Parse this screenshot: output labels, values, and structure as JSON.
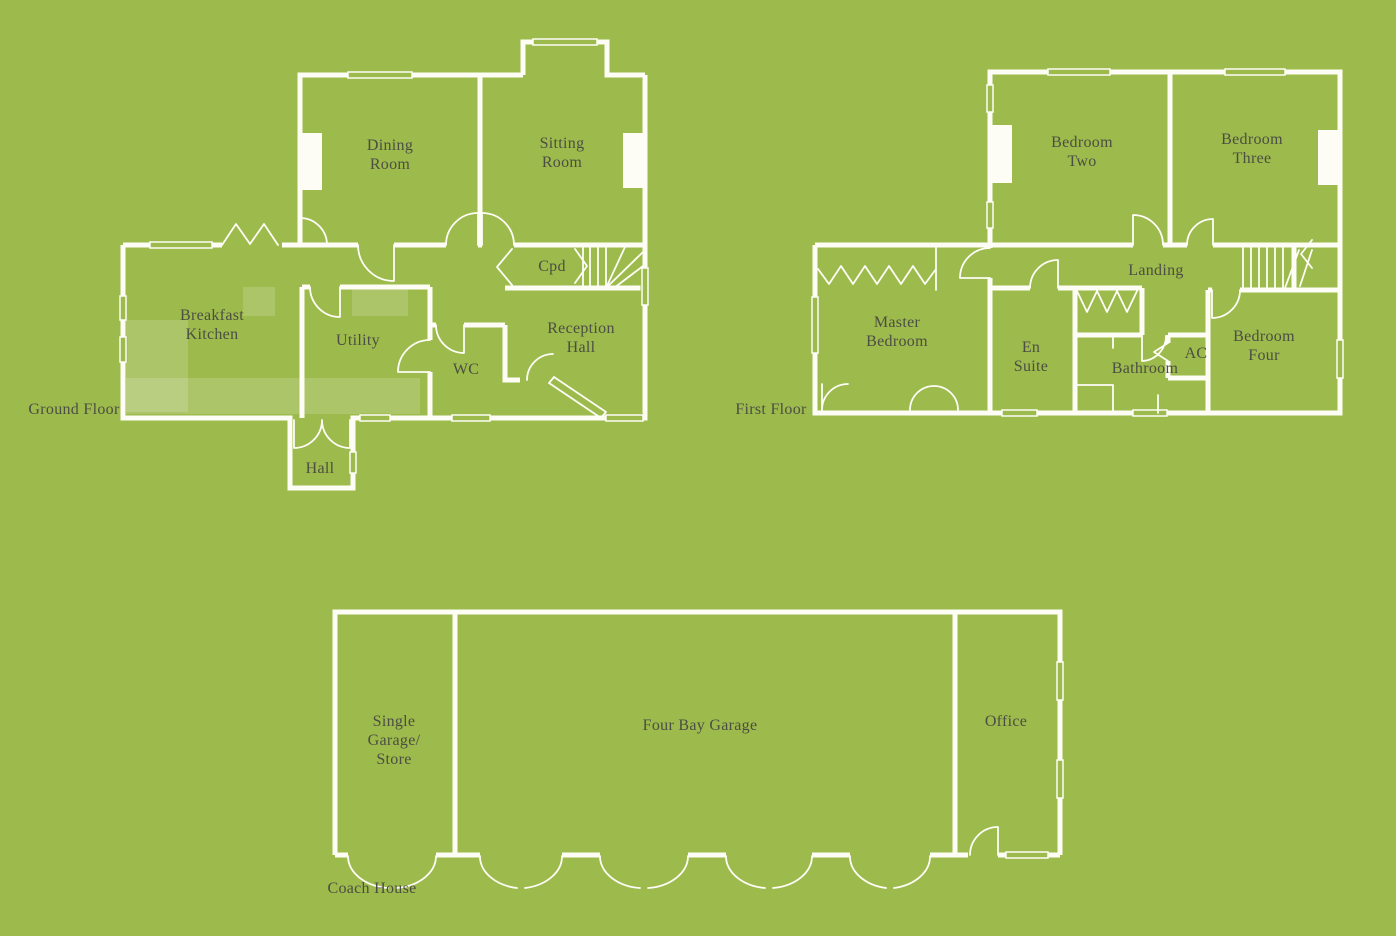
{
  "colors": {
    "background": "#9dba4c",
    "walls": "#fdfdf6",
    "text": "#4c4e43",
    "counter": "rgba(255,255,255,0.16)"
  },
  "plans": {
    "ground": {
      "label": "Ground Floor",
      "rooms": {
        "dining": {
          "lines": [
            "Dining",
            "Room"
          ]
        },
        "sitting": {
          "lines": [
            "Sitting",
            "Room"
          ]
        },
        "kitchen": {
          "lines": [
            "Breakfast",
            "Kitchen"
          ]
        },
        "utility": {
          "lines": [
            "Utility"
          ]
        },
        "wc": {
          "lines": [
            "WC"
          ]
        },
        "reception": {
          "lines": [
            "Reception",
            "Hall"
          ]
        },
        "cpd": {
          "lines": [
            "Cpd"
          ]
        },
        "hall": {
          "lines": [
            "Hall"
          ]
        }
      }
    },
    "first": {
      "label": "First Floor",
      "rooms": {
        "bedroom2": {
          "lines": [
            "Bedroom",
            "Two"
          ]
        },
        "bedroom3": {
          "lines": [
            "Bedroom",
            "Three"
          ]
        },
        "master": {
          "lines": [
            "Master",
            "Bedroom"
          ]
        },
        "ensuite": {
          "lines": [
            "En",
            "Suite"
          ]
        },
        "bathroom": {
          "lines": [
            "Bathroom"
          ]
        },
        "landing": {
          "lines": [
            "Landing"
          ]
        },
        "ac": {
          "lines": [
            "AC"
          ]
        },
        "bedroom4": {
          "lines": [
            "Bedroom",
            "Four"
          ]
        }
      }
    },
    "coach": {
      "label": "Coach House",
      "rooms": {
        "single_garage": {
          "lines": [
            "Single",
            "Garage/",
            "Store"
          ]
        },
        "four_bay": {
          "lines": [
            "Four Bay Garage"
          ]
        },
        "office": {
          "lines": [
            "Office"
          ]
        }
      }
    }
  }
}
